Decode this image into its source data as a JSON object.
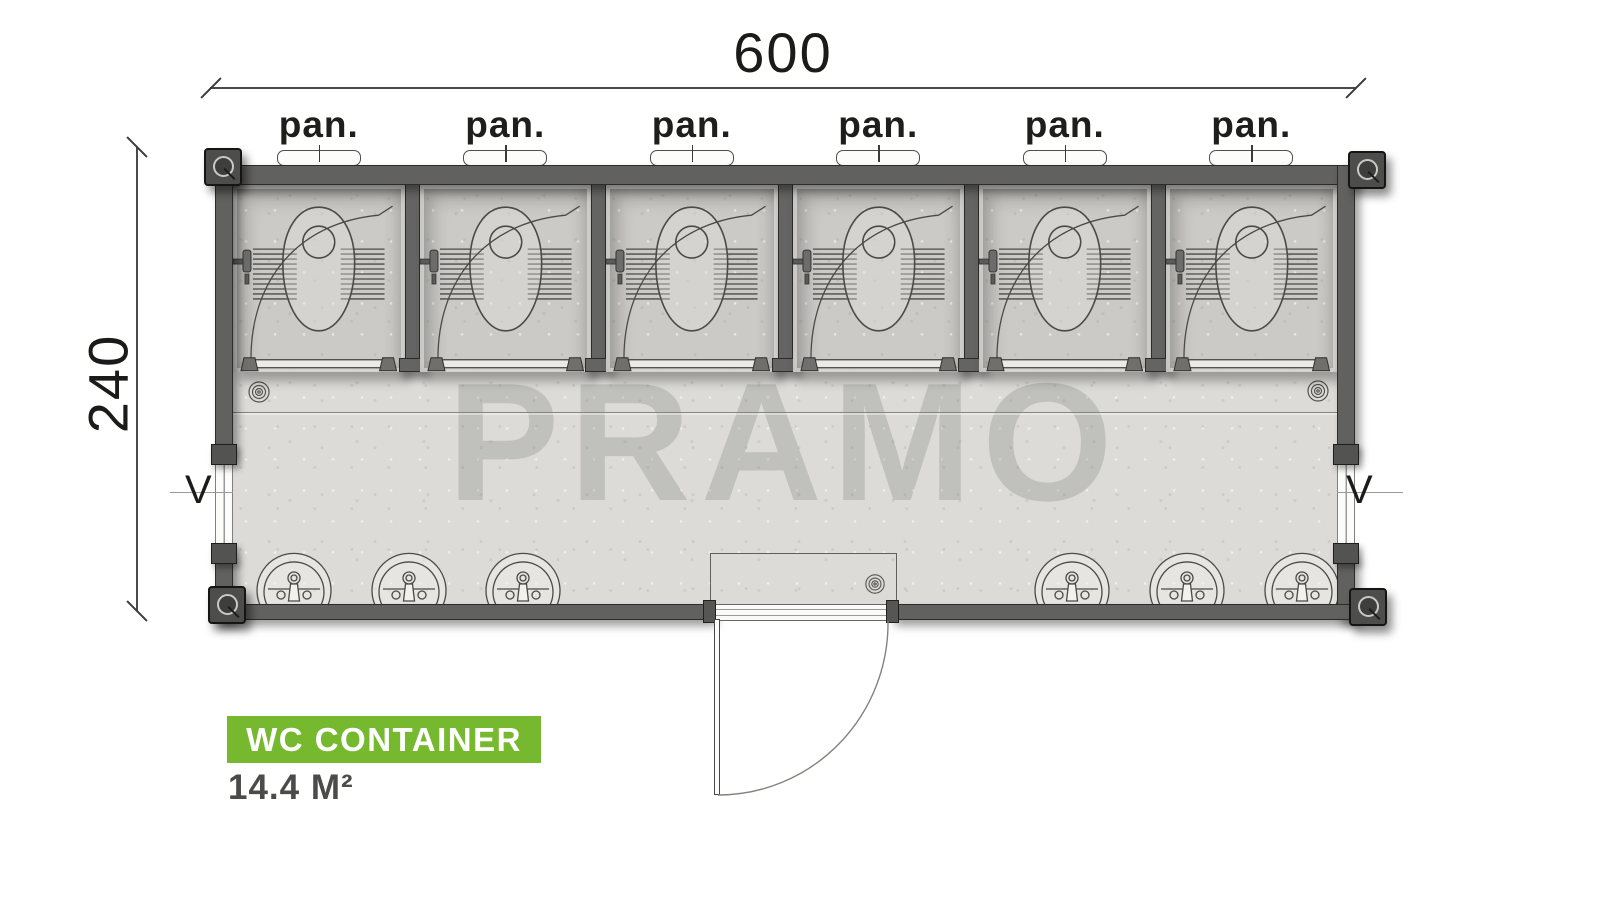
{
  "diagram": {
    "watermark": "PRAMO",
    "dimensions": {
      "width": "600",
      "height": "240"
    },
    "stall_labels": [
      "pan.",
      "pan.",
      "pan.",
      "pan.",
      "pan.",
      "pan."
    ],
    "window_labels": {
      "left": "V",
      "right": "V"
    },
    "badge": {
      "title": "WC CONTAINER",
      "area": "14.4 M²"
    },
    "fixtures": {
      "squat_toilets": 6,
      "sinks": 6,
      "floor_drains": 3,
      "side_windows": 2,
      "entry_doors": 1
    },
    "colors": {
      "accent_green": "#76b82e",
      "wall_gray": "#616160",
      "corridor_floor": "#dcdbd8",
      "stall_floor": "#cbcac7",
      "ink": "#1e1e1c",
      "watermark_gray": "#c6c5c2"
    }
  }
}
